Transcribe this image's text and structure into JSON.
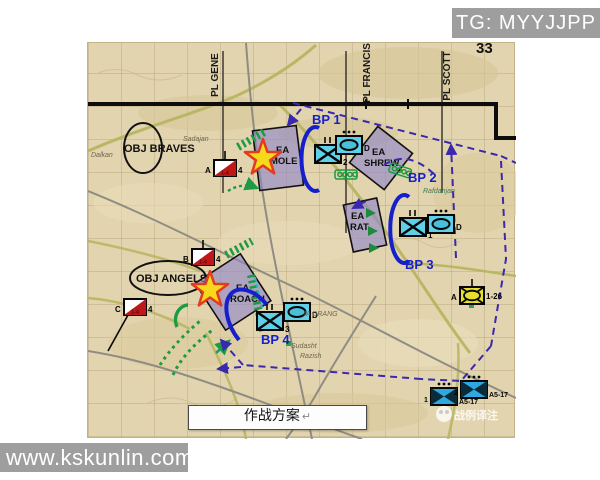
{
  "header": {
    "tg_label": "TG: MYYJJPP",
    "page_number": "33"
  },
  "caption": {
    "text": "作战方案",
    "return_mark": "↵"
  },
  "watermark": {
    "url_text": "www.kskunlin.com",
    "logo_text": "战例译注"
  },
  "map": {
    "phase_lines": [
      {
        "label": "PL GENE"
      },
      {
        "label": "PL FRANCIS"
      },
      {
        "label": "PL SCOTT"
      }
    ],
    "objectives": [
      {
        "label": "OBJ BRAVES"
      },
      {
        "label": "OBJ ANGELS"
      }
    ],
    "engagement_areas": [
      {
        "line1": "EA",
        "line2": "MOLE"
      },
      {
        "line1": "EA",
        "line2": "SHREW"
      },
      {
        "line1": "EA",
        "line2": "RAT"
      },
      {
        "line1": "EA",
        "line2": "ROACH"
      }
    ],
    "battle_positions": [
      {
        "label": "BP 1"
      },
      {
        "label": "BP 2"
      },
      {
        "label": "BP 3"
      },
      {
        "label": "BP 4"
      }
    ],
    "units": {
      "mech_battalions": [
        {
          "echelon": "II",
          "number": "2"
        },
        {
          "echelon": "II",
          "number": "1"
        },
        {
          "echelon": "II",
          "number": "3"
        }
      ],
      "armor_companies": [
        {
          "letter": "D"
        },
        {
          "letter": "D"
        },
        {
          "letter": "D"
        }
      ],
      "guidons": [
        {
          "letter": "A",
          "number": "4",
          "inner": "1-4"
        },
        {
          "letter": "B",
          "number": "4",
          "inner": "1-4"
        },
        {
          "letter": "C",
          "number": "4",
          "inner": "1-4"
        }
      ],
      "cavalry_troop": {
        "letter": "A",
        "number": "1-26"
      },
      "task_forces": [
        {
          "number": "1",
          "designation": "A5-17"
        },
        {
          "number": "2",
          "designation": "A5-17"
        }
      ]
    },
    "places": [
      "Sadajan",
      "Dalkan",
      "Rafdanjan",
      "Sudasht",
      "Razish",
      "IA DRANG"
    ],
    "colors": {
      "friendly_unit_fill": "#5fd0e8",
      "task_force_fill": "#2fa8e0",
      "cavalry_fill": "#e6df2e",
      "guidon_red": "#c01818",
      "ea_fill": "#8f86c9",
      "bp_blue": "#1520cc",
      "enemy_dash": "#3a28b0",
      "obstacle_green": "#1d9a44",
      "star_fill": "#f8d81c",
      "star_stroke": "#e23b1e"
    }
  }
}
